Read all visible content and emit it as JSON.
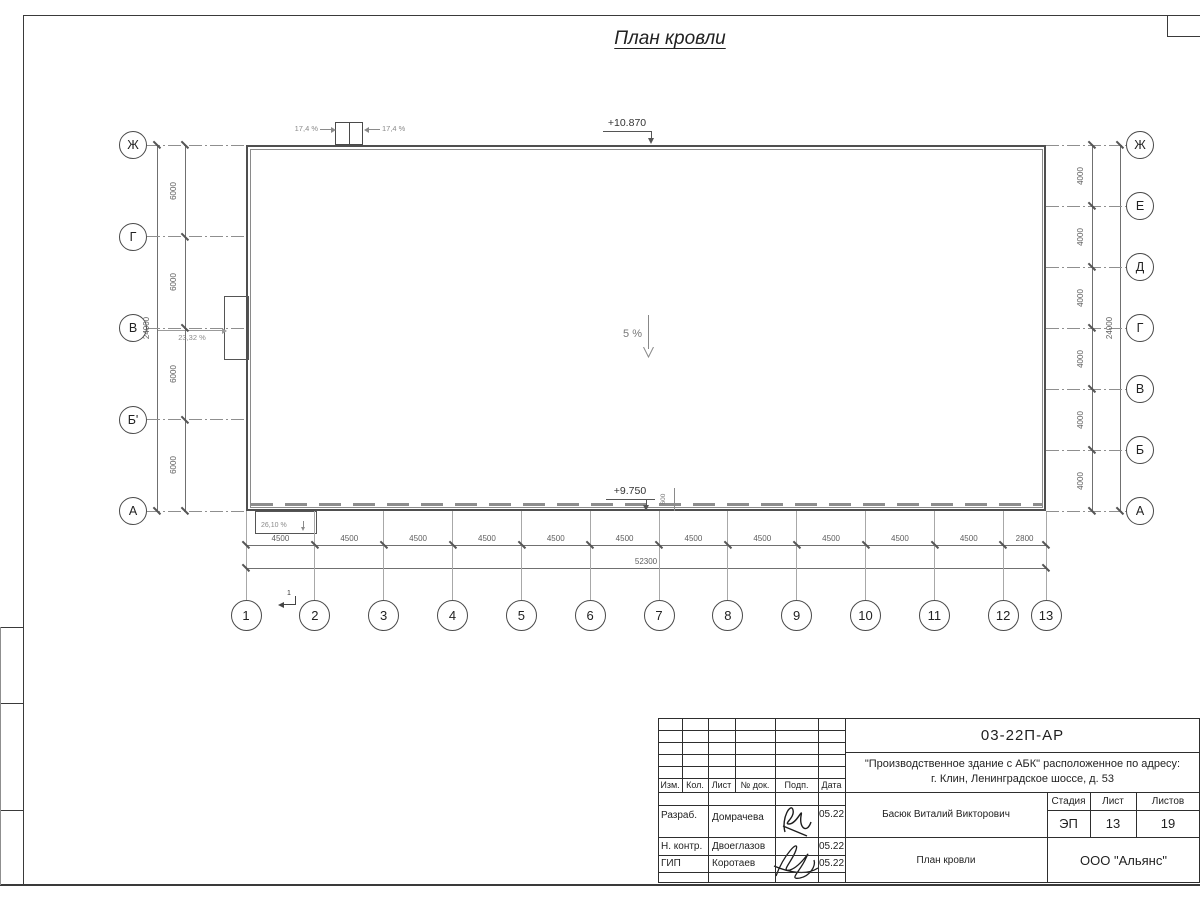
{
  "plan": {
    "title": "План кровли",
    "elevation_top": "+10.870",
    "elevation_bottom": "+9.750",
    "slope_center": "5 %",
    "slope_left_canopy": "23,32 %",
    "slope_bottom_canopy": "26,10 %",
    "slope_hatch_left": "17,4 %",
    "slope_hatch_right": "17,4 %",
    "section_mark": "1",
    "parapet_dim": "600"
  },
  "axes": {
    "left": [
      "Ж",
      "Г",
      "В",
      "Б'",
      "А"
    ],
    "right": [
      "Ж",
      "Е",
      "Д",
      "Г",
      "В",
      "Б",
      "А"
    ],
    "bottom": [
      "1",
      "2",
      "3",
      "4",
      "5",
      "6",
      "7",
      "8",
      "9",
      "10",
      "11",
      "12",
      "13"
    ]
  },
  "dimensions": {
    "left_segments": [
      "6000",
      "6000",
      "6000",
      "6000"
    ],
    "left_total": "24000",
    "right_segments": [
      "4000",
      "4000",
      "4000",
      "4000",
      "4000",
      "4000"
    ],
    "right_total": "24000",
    "bottom_segments": [
      "4500",
      "4500",
      "4500",
      "4500",
      "4500",
      "4500",
      "4500",
      "4500",
      "4500",
      "4500",
      "4500",
      "2800"
    ],
    "bottom_total": "52300"
  },
  "title_block": {
    "doc_number": "03-22П-АР",
    "project_line1": "\"Производственное здание с АБК\" расположенное по адресу:",
    "project_line2": "г. Клин, Ленинградское шоссе, д. 53",
    "columns": [
      "Изм.",
      "Кол.",
      "Лист",
      "№ док.",
      "Подп.",
      "Дата"
    ],
    "rows": [
      {
        "role": "Разраб.",
        "name": "Домрачева",
        "date": "05.22"
      },
      {
        "role": "Н. контр.",
        "name": "Двоеглазов",
        "date": "05.22"
      },
      {
        "role": "ГИП",
        "name": "Коротаев",
        "date": "05.22"
      }
    ],
    "approver": "Басюк Виталий Викторович",
    "stage_label": "Стадия",
    "stage": "ЭП",
    "sheet_label": "Лист",
    "sheet": "13",
    "sheets_label": "Листов",
    "sheets": "19",
    "drawing_name": "План кровли",
    "company": "ООО \"Альянс\""
  },
  "colors": {
    "line": "#3f3f3f",
    "dim_line": "#707070",
    "gray_text": "#8a8a8a"
  }
}
